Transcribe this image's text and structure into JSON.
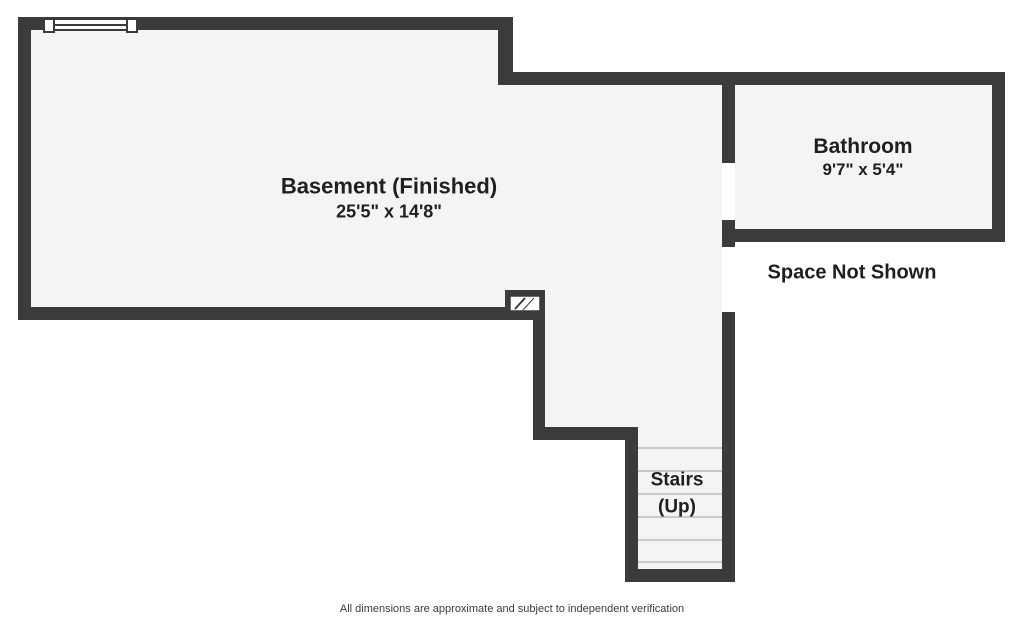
{
  "plan": {
    "title": "Basement floor plan",
    "rooms": {
      "basement": {
        "name": "Basement (Finished)",
        "dimensions": "25'5\" x 14'8\""
      },
      "bathroom": {
        "name": "Bathroom",
        "dimensions": "9'7\" x 5'4\""
      },
      "stairs": {
        "line1": "Stairs",
        "line2": "(Up)"
      }
    },
    "annotations": {
      "space_not_shown": "Space Not Shown"
    },
    "symbols": [
      "window-symbol",
      "chimney-hatch-symbol",
      "stair-treads",
      "door-openings"
    ],
    "footer": {
      "disclaimer": "All dimensions are approximate and subject to independent verification"
    }
  },
  "colors": {
    "wall": "#3b3b3b",
    "floor": "#f4f4f4",
    "bg": "#ffffff",
    "tread": "#c9c9c9",
    "text": "#1f1f1f",
    "footer": "#3b3b3b"
  }
}
